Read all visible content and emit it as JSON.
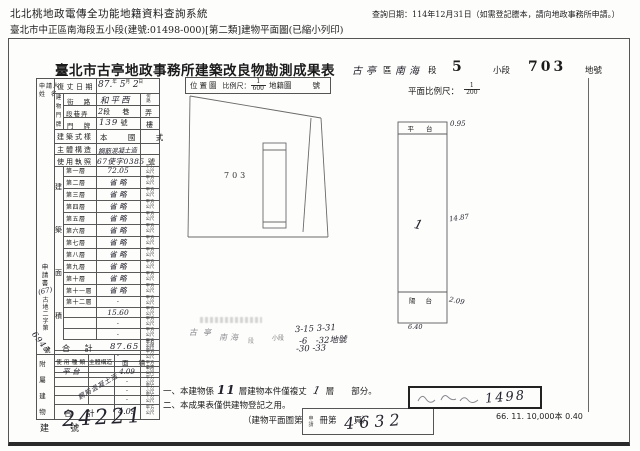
{
  "header": {
    "system_title": "北北桃地政電傳全功能地籍資料查詢系統",
    "query_date": "查詢日期：114年12月31日（如需登記謄本，請向地政事務所申請。）",
    "subtitle": "臺北市中正區南海段五小段(建號:01498-000)[第二類]建物平面圖(已縮小列印)"
  },
  "form": {
    "title": "臺北市古亭地政事務所建築改良物勘測成果表",
    "location": {
      "district": "古亭",
      "district_label": "區",
      "section": "南海",
      "section_label": "段",
      "subsection": "5",
      "subsection_label": "小段",
      "parcel": "703",
      "parcel_label": "地號"
    },
    "applicant": {
      "line1": "申請人",
      "line2": "姓 名",
      "doc_word": "申請書",
      "doc_year": "(67)",
      "doc_prefix": "古地二字第",
      "doc_no": "6945",
      "doc_suffix": "號"
    },
    "survey_date": {
      "label": "復丈日期",
      "y": "87.",
      "y_u": "年",
      "m": "5",
      "m_u": "月",
      "d": "2",
      "d_u": "日"
    },
    "address": {
      "group": "建物門牌",
      "street_label": "街 路",
      "street": "和平西",
      "street_suffix": "街路",
      "lane_label": "段巷弄",
      "lane_value": "2",
      "lane_u1": "段",
      "lane_u2": "巷",
      "lane_u3": "弄",
      "no_label": "門 牌",
      "no_value": "139",
      "no_u1": "號",
      "no_u2": "樓"
    },
    "style": {
      "label": "建築式樣",
      "value": "本 國 式"
    },
    "structure": {
      "label": "主體構造",
      "value": "鋼筋混凝土造"
    },
    "license": {
      "label": "使用執照",
      "value": "67使字0385",
      "suffix": "號"
    },
    "area": {
      "group": "建築面積",
      "unit": "平方公尺",
      "floors": [
        {
          "label": "第一層",
          "value": "72.05"
        },
        {
          "label": "第二層",
          "value": "省 略"
        },
        {
          "label": "第三層",
          "value": "省 略"
        },
        {
          "label": "第四層",
          "value": "省 略"
        },
        {
          "label": "第五層",
          "value": "省 略"
        },
        {
          "label": "第六層",
          "value": "省 略"
        },
        {
          "label": "第七層",
          "value": "省 略"
        },
        {
          "label": "第八層",
          "value": "省 略"
        },
        {
          "label": "第九層",
          "value": "省 略"
        },
        {
          "label": "第十層",
          "value": "省 略"
        },
        {
          "label": "第十一層",
          "value": "省 略"
        },
        {
          "label": "第十二層",
          "value": "·"
        },
        {
          "label": "",
          "value": "15.60"
        },
        {
          "label": "",
          "value": "·"
        },
        {
          "label": "",
          "value": "·"
        },
        {
          "label": "",
          "value": "·"
        },
        {
          "label": "",
          "value": "·"
        },
        {
          "label": "",
          "value": "·"
        }
      ],
      "total_label": "合  計",
      "total": "87.65"
    },
    "annex": {
      "group": "附屬建物",
      "h1": "使用種類",
      "h2": "主體構造",
      "h3": "面  積",
      "structure_note": "鋼筋混凝土造",
      "rows": [
        {
          "type": "平 台",
          "value": "4.09"
        },
        {
          "type": "",
          "value": "·"
        },
        {
          "type": "",
          "value": "·"
        },
        {
          "type": "",
          "value": "·"
        }
      ],
      "total_label": "合  計",
      "total": "4.09",
      "unit": "平方公尺"
    },
    "map": {
      "label": "位置圖",
      "scale_label": "比例尺：",
      "num": "1",
      "den": "600",
      "ref": "地籍圖",
      "ref_no": "號",
      "parcel": "703",
      "note": {
        "p1": "古亭",
        "p2": "南海",
        "p3": "段",
        "p4": "小段",
        "l1": "3-15  3-31",
        "l2": "-6　-32地號",
        "l3": "-30  -33"
      }
    },
    "plan": {
      "scale_label": "平面比例尺：",
      "num": "1",
      "den": "200",
      "top": "平 台",
      "top_dim": "0.95",
      "floor_mark": "1",
      "mid_dim": "14.87",
      "bottom": "陽 台",
      "bottom_dim": "2.09",
      "width_dim": "6.40"
    },
    "notes": {
      "n1a": "一、本建物係",
      "n1b": "11",
      "n1c": "層建物本件僅複丈",
      "n1d": "1",
      "n1e": "層　　部分。",
      "n2": "二、本成果表僅供建物登記之用。"
    },
    "footer": {
      "bn_label": "建　號",
      "bn": "24221",
      "plan_ref": "（建物平面圖第　　冊第　　頁）",
      "stamp_small": "申請",
      "stamp_no": "4632",
      "stamp_right": "1498",
      "print": "66. 11. 10,000本 0.40"
    }
  }
}
